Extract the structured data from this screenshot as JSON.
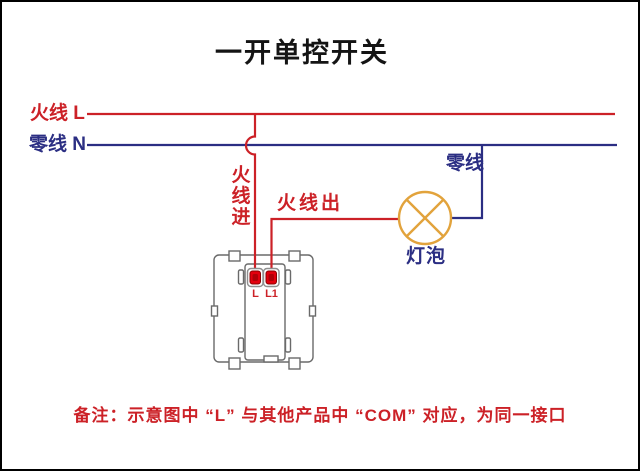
{
  "title": "一开单控开关",
  "note": "备注：示意图中 “L” 与其他产品中 “COM” 对应，为同一接口",
  "labels": {
    "live_left": "火线 L",
    "neutral_left": "零线 N",
    "live_in": "火线进",
    "live_out": "火线出",
    "neutral_right": "零线",
    "lamp": "灯泡",
    "terminal_l": "L",
    "terminal_l1": "L1"
  },
  "icons": {
    "lamp_symbol": "lamp-circle-with-cross-icon",
    "switch_symbol": "wall-switch-plate-icon"
  },
  "colors": {
    "live": "#cc2127",
    "neutral": "#2b2e83",
    "lamp": "#e2a33c",
    "outline": "#6a6a6a",
    "terminal": "#e3000e",
    "title": "#141414",
    "background": "#ffffff",
    "border": "#000000"
  }
}
